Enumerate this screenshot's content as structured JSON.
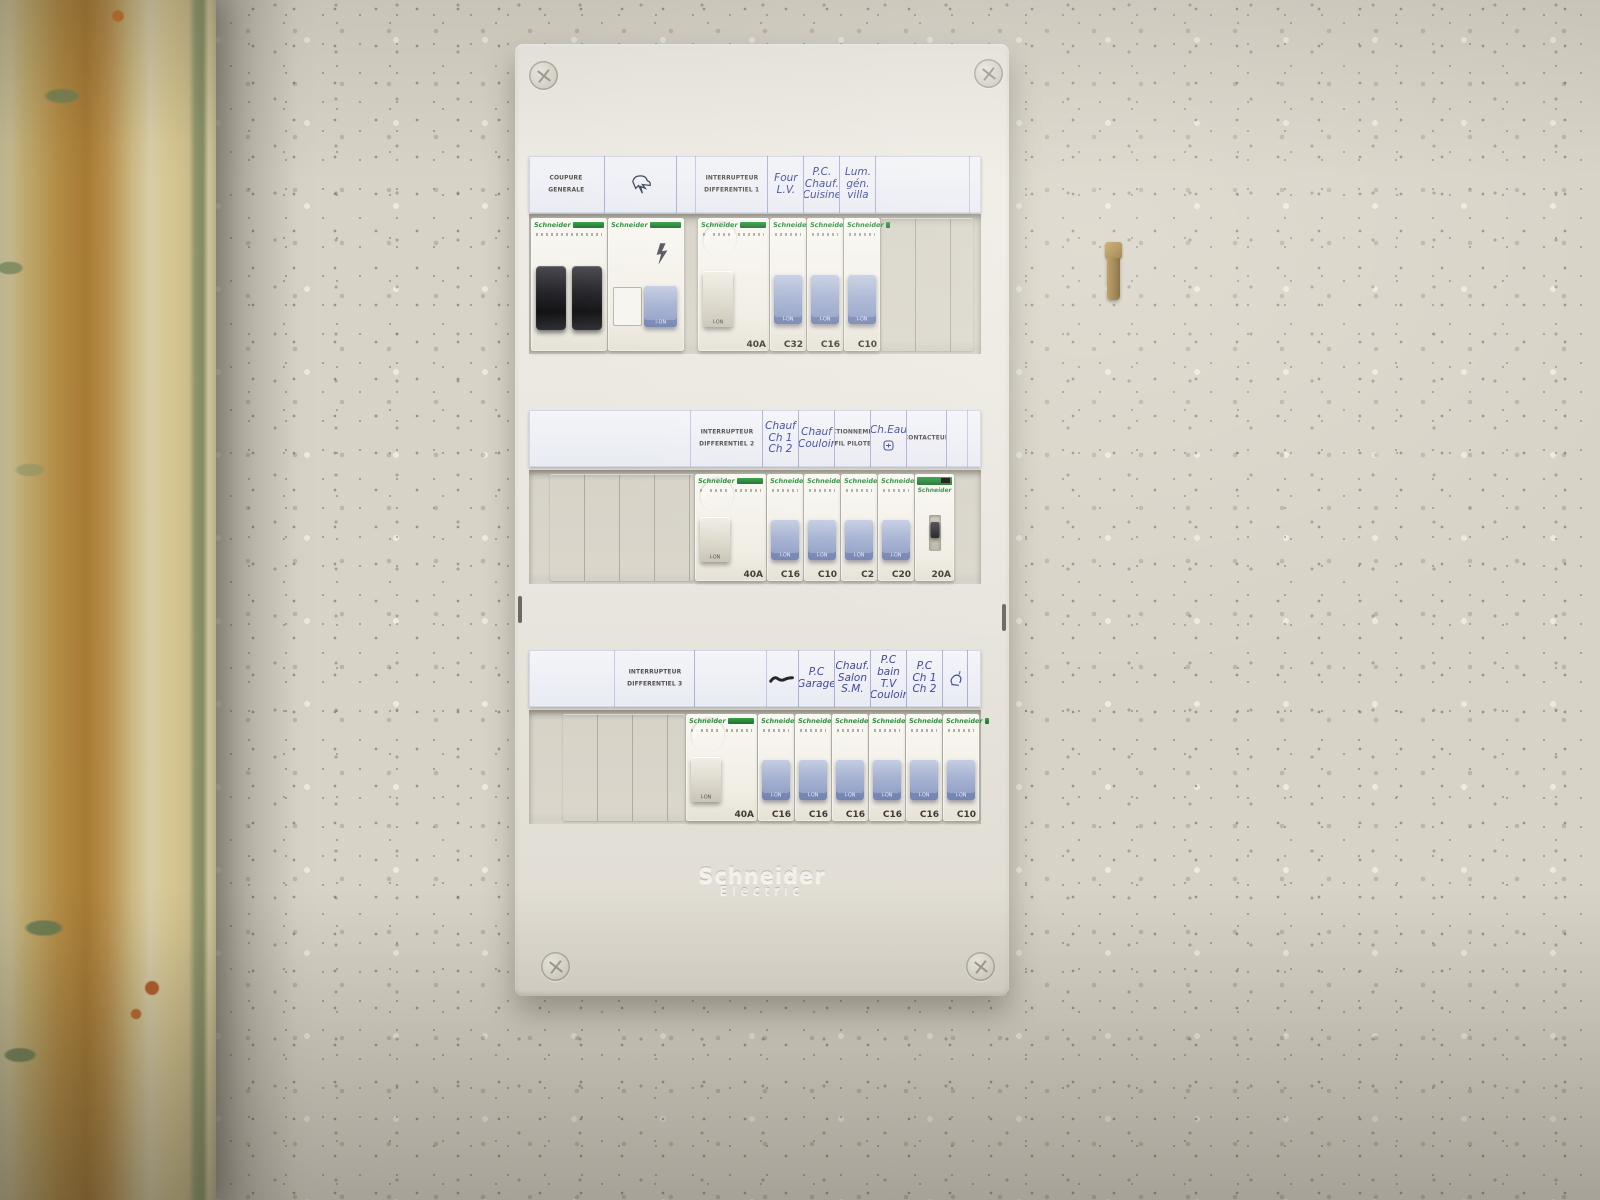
{
  "colors": {
    "wall": "#d8d3c7",
    "panel_face": "#e9e6df",
    "label_strip": "#eef0f6",
    "handwriting_ink": "#3f49a0",
    "schneider_green": "#2f8f3f",
    "toggle_blue": "#9aa8cc",
    "main_toggle_black": "#232327",
    "curtain_yellow": "#cf9f4a"
  },
  "panel": {
    "device_brand": "Schneider",
    "toggle_label": "I-ON",
    "embossed_logo": {
      "line1": "Schneider",
      "line2": "Electric"
    },
    "rows": [
      {
        "labels": [
          {
            "kind": "printed",
            "lines": [
              "COUPURE",
              "GENERALE"
            ],
            "span": 2.1
          },
          {
            "kind": "icon",
            "icon": "lightning-doodle-icon",
            "span": 2.0
          },
          {
            "kind": "empty",
            "span": 0.55
          },
          {
            "kind": "printed",
            "lines": [
              "INTERRUPTEUR",
              "DIFFERENTIEL 1"
            ],
            "span": 2.0
          },
          {
            "kind": "hand",
            "lines": [
              "Four",
              "L.V."
            ],
            "span": 1.0
          },
          {
            "kind": "hand",
            "lines": [
              "P.C.",
              "Chauf.",
              "Cuisine"
            ],
            "span": 1.0
          },
          {
            "kind": "hand",
            "lines": [
              "Lum.",
              "gén.",
              "villa"
            ],
            "span": 1.0
          },
          {
            "kind": "empty",
            "span": 2.6
          }
        ],
        "devices": [
          {
            "type": "main2p",
            "rating": ""
          },
          {
            "type": "surge",
            "rating": ""
          },
          {
            "type": "gap",
            "span": 0.33
          },
          {
            "type": "diff",
            "rating": "40A"
          },
          {
            "type": "mcb",
            "rating": "C32"
          },
          {
            "type": "mcb",
            "rating": "C16"
          },
          {
            "type": "mcb",
            "rating": "C10"
          },
          {
            "type": "blank",
            "slots": 2.55
          }
        ]
      },
      {
        "labels": [
          {
            "kind": "empty",
            "span": 4.5
          },
          {
            "kind": "printed",
            "lines": [
              "INTERRUPTEUR",
              "DIFFERENTIEL 2"
            ],
            "span": 2.0
          },
          {
            "kind": "hand",
            "lines": [
              "Chauf",
              "Ch 1",
              "Ch 2"
            ],
            "span": 1.0
          },
          {
            "kind": "hand",
            "lines": [
              "Chauf",
              "Couloir"
            ],
            "span": 1.0
          },
          {
            "kind": "printed",
            "lines": [
              "SECTIONNEMENT",
              "FIL PILOTE"
            ],
            "span": 1.0
          },
          {
            "kind": "hand",
            "lines": [
              "Ch.Eau"
            ],
            "icon": "water-heater-icon",
            "span": 1.0
          },
          {
            "kind": "printed",
            "lines": [
              "CONTACTEUR"
            ],
            "span": 1.1
          },
          {
            "kind": "empty",
            "span": 0.6
          }
        ],
        "devices": [
          {
            "type": "gap",
            "span": 0.5
          },
          {
            "type": "blank",
            "slots": 4.0
          },
          {
            "type": "diff",
            "rating": "40A"
          },
          {
            "type": "mcb",
            "rating": "C16"
          },
          {
            "type": "mcb",
            "rating": "C10"
          },
          {
            "type": "mcb",
            "rating": "C2"
          },
          {
            "type": "mcb",
            "rating": "C20"
          },
          {
            "type": "contactor",
            "rating": "20A"
          }
        ]
      },
      {
        "labels": [
          {
            "kind": "empty",
            "span": 2.4
          },
          {
            "kind": "printed",
            "lines": [
              "INTERRUPTEUR",
              "DIFFERENTIEL 3"
            ],
            "span": 2.2
          },
          {
            "kind": "empty",
            "span": 2.0
          },
          {
            "kind": "icon",
            "icon": "scribble-icon",
            "span": 0.9
          },
          {
            "kind": "hand",
            "lines": [
              "P.C",
              "Garage"
            ],
            "span": 1.0
          },
          {
            "kind": "hand",
            "lines": [
              "Chauf.",
              "Salon",
              "S.M."
            ],
            "span": 1.0
          },
          {
            "kind": "hand",
            "lines": [
              "P.C",
              "bain",
              "T.V",
              "Couloir"
            ],
            "span": 1.0
          },
          {
            "kind": "hand",
            "lines": [
              "P.C",
              "Ch 1",
              "Ch 2"
            ],
            "span": 1.0
          },
          {
            "kind": "icon",
            "icon": "lamp-doodle-icon",
            "span": 0.7
          }
        ],
        "devices": [
          {
            "type": "gap",
            "span": 0.85
          },
          {
            "type": "blank",
            "slots": 3.4
          },
          {
            "type": "diff",
            "rating": "40A"
          },
          {
            "type": "mcb",
            "rating": "C16"
          },
          {
            "type": "mcb",
            "rating": "C16"
          },
          {
            "type": "mcb",
            "rating": "C16"
          },
          {
            "type": "mcb",
            "rating": "C16"
          },
          {
            "type": "mcb",
            "rating": "C16"
          },
          {
            "type": "mcb",
            "rating": "C10"
          }
        ]
      }
    ]
  }
}
